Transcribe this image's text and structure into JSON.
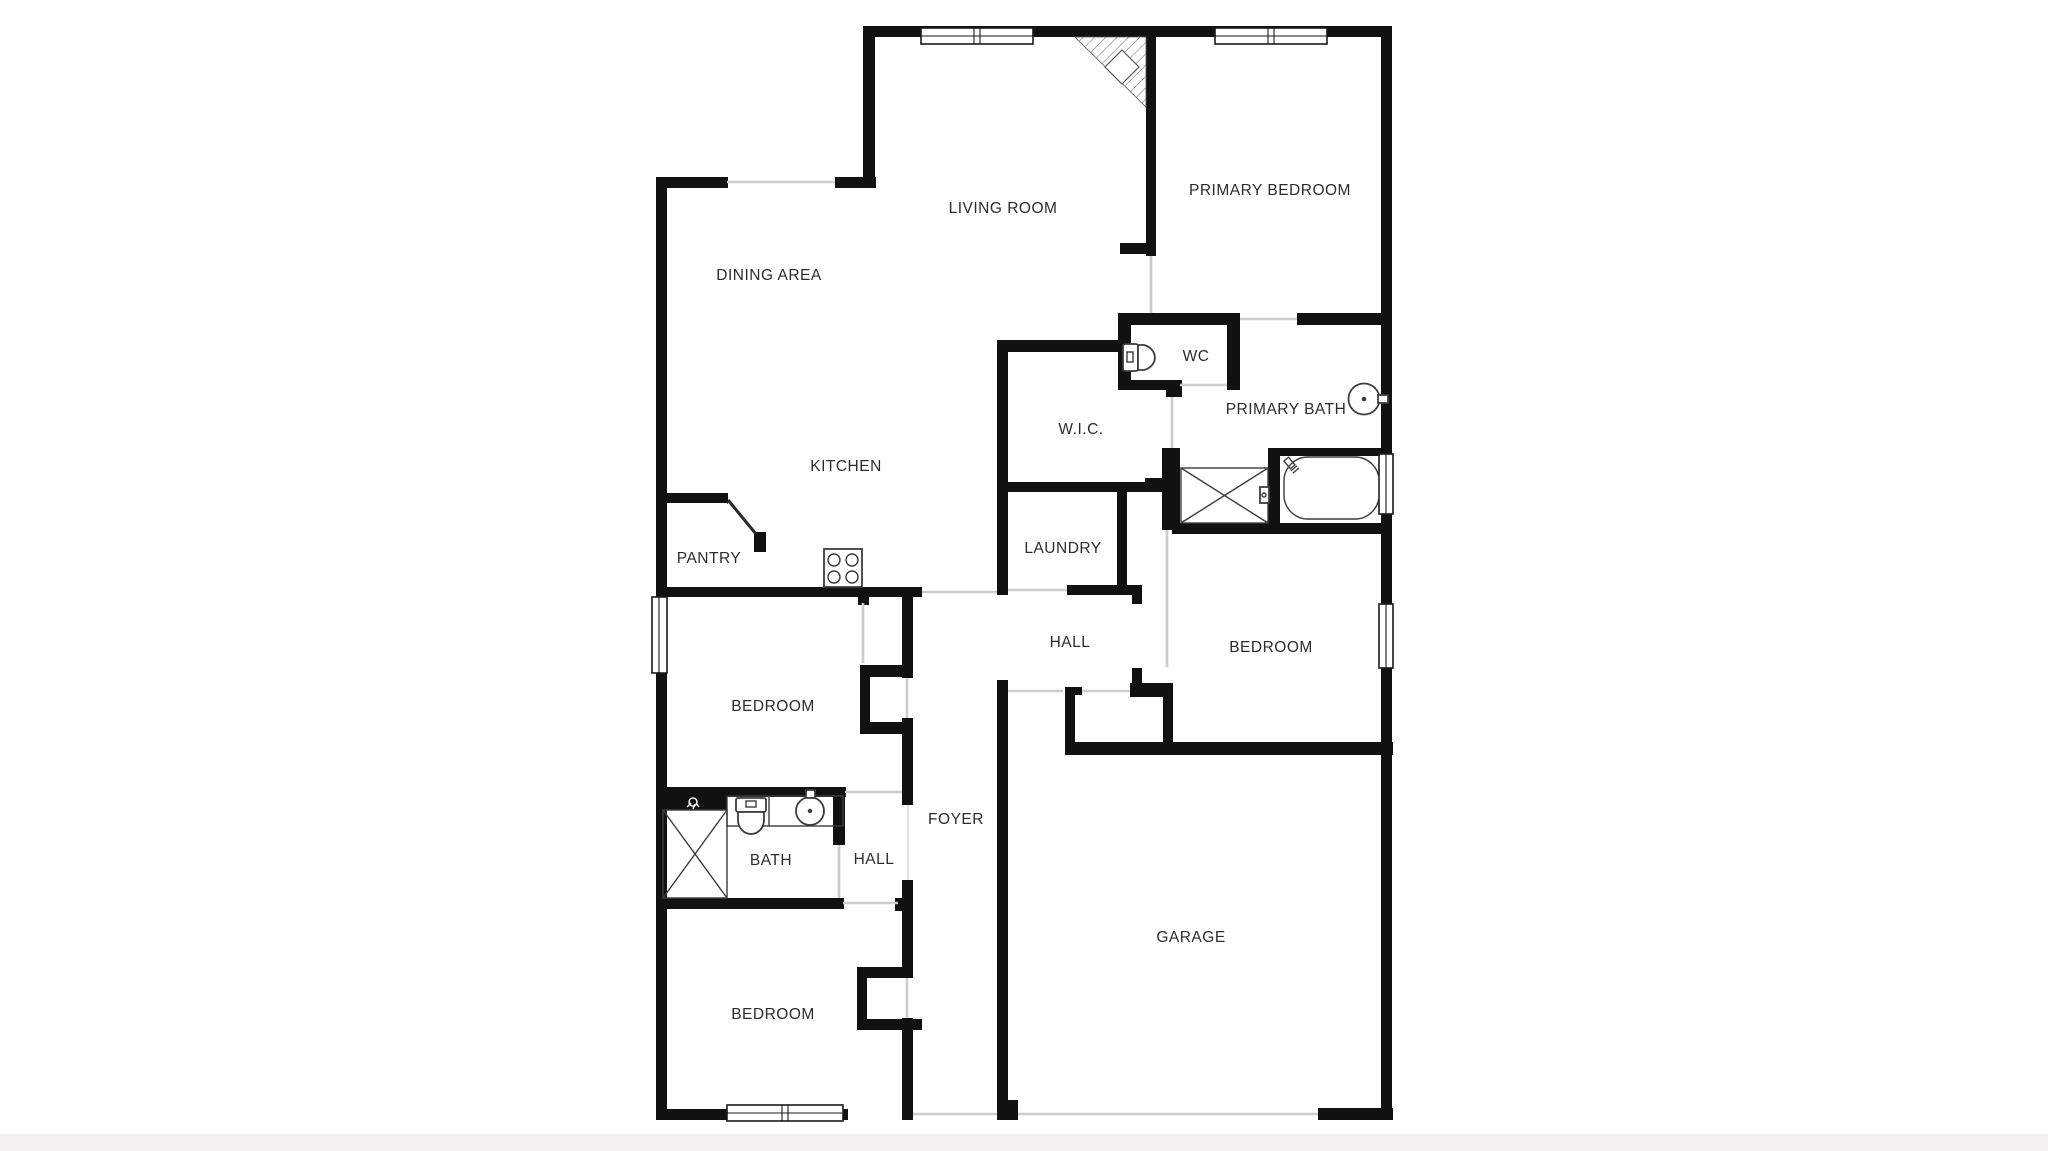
{
  "title": "Residential floor plan",
  "colors": {
    "wall": "#111111",
    "door_opening": "#cccccc",
    "fixture": "#3c3c3c",
    "label": "#2c2c2c",
    "ground_strip": "#f2f1ee",
    "background": "#ffffff"
  },
  "rooms": [
    {
      "id": "living-room",
      "label": "LIVING ROOM",
      "x": 1003,
      "y": 209
    },
    {
      "id": "primary-bedroom",
      "label": "PRIMARY BEDROOM",
      "x": 1270,
      "y": 191
    },
    {
      "id": "dining-area",
      "label": "DINING AREA",
      "x": 769,
      "y": 276
    },
    {
      "id": "wc",
      "label": "WC",
      "x": 1196,
      "y": 357
    },
    {
      "id": "primary-bath",
      "label": "PRIMARY BATH",
      "x": 1286,
      "y": 410
    },
    {
      "id": "wic",
      "label": "W.I.C.",
      "x": 1081,
      "y": 430
    },
    {
      "id": "kitchen",
      "label": "KITCHEN",
      "x": 846,
      "y": 467
    },
    {
      "id": "laundry",
      "label": "LAUNDRY",
      "x": 1063,
      "y": 549
    },
    {
      "id": "pantry",
      "label": "PANTRY",
      "x": 709,
      "y": 559
    },
    {
      "id": "hall-upper",
      "label": "HALL",
      "x": 1070,
      "y": 643
    },
    {
      "id": "bedroom-right",
      "label": "BEDROOM",
      "x": 1271,
      "y": 648
    },
    {
      "id": "bedroom-left",
      "label": "BEDROOM",
      "x": 773,
      "y": 707
    },
    {
      "id": "bath",
      "label": "BATH",
      "x": 771,
      "y": 861
    },
    {
      "id": "hall-lower",
      "label": "HALL",
      "x": 874,
      "y": 860
    },
    {
      "id": "foyer",
      "label": "FOYER",
      "x": 956,
      "y": 820
    },
    {
      "id": "bedroom-bottom",
      "label": "BEDROOM",
      "x": 773,
      "y": 1015
    },
    {
      "id": "garage",
      "label": "GARAGE",
      "x": 1191,
      "y": 938
    }
  ],
  "fixtures": [
    {
      "icon": "toilet-icon",
      "room": "wc"
    },
    {
      "icon": "toilet-icon",
      "room": "bath"
    },
    {
      "icon": "sink-icon",
      "room": "primary-bath"
    },
    {
      "icon": "sink-icon",
      "room": "bath"
    },
    {
      "icon": "bathtub-icon",
      "room": "primary-bath"
    },
    {
      "icon": "shower-icon",
      "room": "primary-bath"
    },
    {
      "icon": "shower-icon",
      "room": "bath"
    },
    {
      "icon": "stove-icon",
      "room": "kitchen"
    },
    {
      "icon": "fireplace-icon",
      "room": "living-room"
    }
  ],
  "window_count": 6
}
